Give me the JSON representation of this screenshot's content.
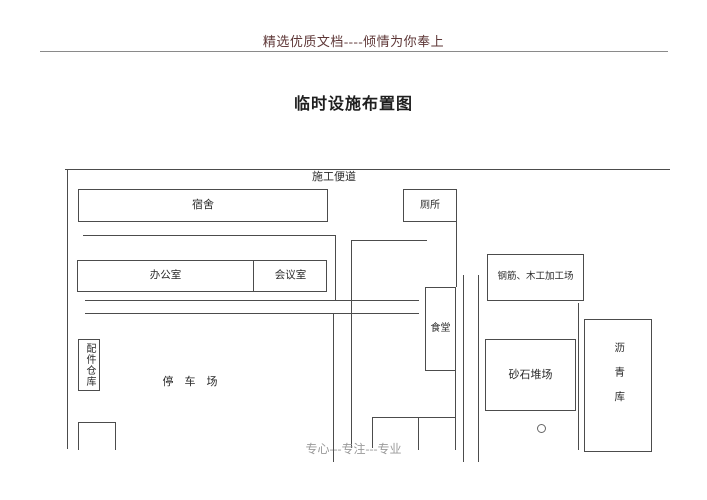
{
  "page": {
    "header": "精选优质文档----倾情为你奉上",
    "title": "临时设施布置图",
    "footer": "专心---专注---专业"
  },
  "diagram": {
    "labels": {
      "road": "施工便道",
      "dormitory": "宿舍",
      "toilet": "厕所",
      "office": "办公室",
      "meeting_room": "会议室",
      "canteen": "食堂",
      "rebar_wood_workshop": "钢筋、木工加工场",
      "parts_warehouse": "配件仓库",
      "parking": "停　车　场",
      "sand_gravel_yard": "砂石堆场",
      "asphalt_storage": "沥青库"
    }
  },
  "colors": {
    "header_text": "#5e3737",
    "diagram_line": "#4c4c4c",
    "footer_text": "#9a9a9a",
    "body_text": "#2b2b2b"
  }
}
